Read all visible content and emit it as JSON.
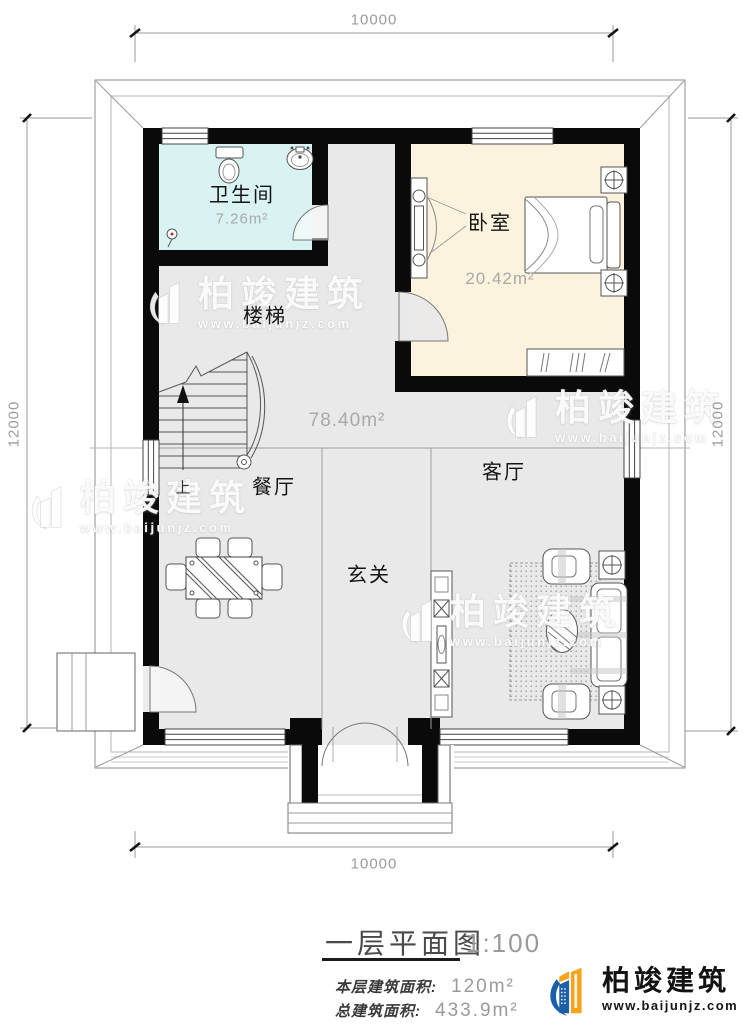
{
  "plan": {
    "dims": {
      "top": "10000",
      "bottom": "10000",
      "left": "12000",
      "right": "12000"
    },
    "rooms": {
      "bathroom": {
        "name": "卫生间",
        "area": "7.26m²"
      },
      "bedroom": {
        "name": "卧室",
        "area": "20.42m²"
      },
      "stairs": {
        "name": "楼梯",
        "up": "上"
      },
      "hall": {
        "area": "78.40m²"
      },
      "dining": {
        "name": "餐厅"
      },
      "living": {
        "name": "客厅"
      },
      "foyer": {
        "name": "玄关"
      }
    }
  },
  "watermark": {
    "brand": "柏竣建筑",
    "url": "www.baijunjz.com"
  },
  "title_block": {
    "title": "一层平面图",
    "scale": "1:100",
    "floor_area_label": "本层建筑面积:",
    "floor_area_value": "120m²",
    "total_area_label": "总建筑面积:",
    "total_area_value": "433.9m²"
  },
  "brand": {
    "name": "柏竣建筑",
    "url": "www.baijunjz.com"
  },
  "colors": {
    "bathroom_fill": "#d9f3f2",
    "bedroom_fill": "#fbf3dd",
    "floor_fill": "#e9e9e9",
    "wall": "#0a0a0a",
    "brand_blue": "#1a5fa8",
    "brand_orange": "#f7a41d"
  }
}
